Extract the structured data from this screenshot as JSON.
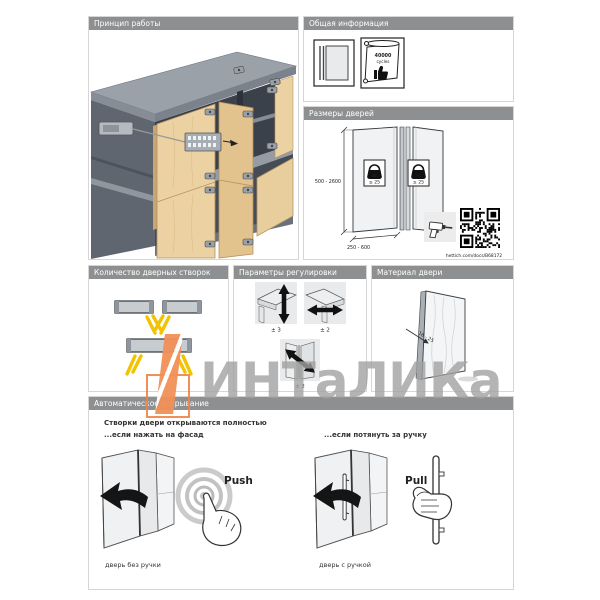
{
  "colors": {
    "header_bg": "#8d8f91",
    "accent_orange": "#ef8347",
    "hinge_yellow": "#f2c300",
    "wood": "#ecd2a3"
  },
  "panels": {
    "principle": {
      "title": "Принцип работы"
    },
    "general_info": {
      "title": "Общая информация",
      "cert_line1": "40000",
      "cert_line2": "cycles"
    },
    "door_sizes": {
      "title": "Размеры дверей",
      "height_range": "500 - 2600",
      "width_range": "250 - 600",
      "weight_limit": "≤ 25",
      "weight_unit": "kg",
      "link": "hettich.com/docs/B68172"
    },
    "door_count": {
      "title": "Количество дверных створок"
    },
    "adjustment": {
      "title": "Параметры регулировки",
      "vertical": "± 3",
      "horizontal": "± 2",
      "depth": "± 2"
    },
    "door_material": {
      "title": "Материал двери",
      "thickness_range": "16 - 25"
    },
    "auto_opening": {
      "title": "Автоматическое открывание",
      "headline": "Створки двери открываются полностью",
      "push_line": "...если нажать на фасад",
      "pull_line": "...если потянуть за ручку",
      "push_label": "Push",
      "pull_label": "Pull",
      "caption_no_handle": "дверь без ручки",
      "caption_handle": "дверь с ручкой"
    }
  },
  "watermark": {
    "text": "ИНТаЛИКа"
  }
}
